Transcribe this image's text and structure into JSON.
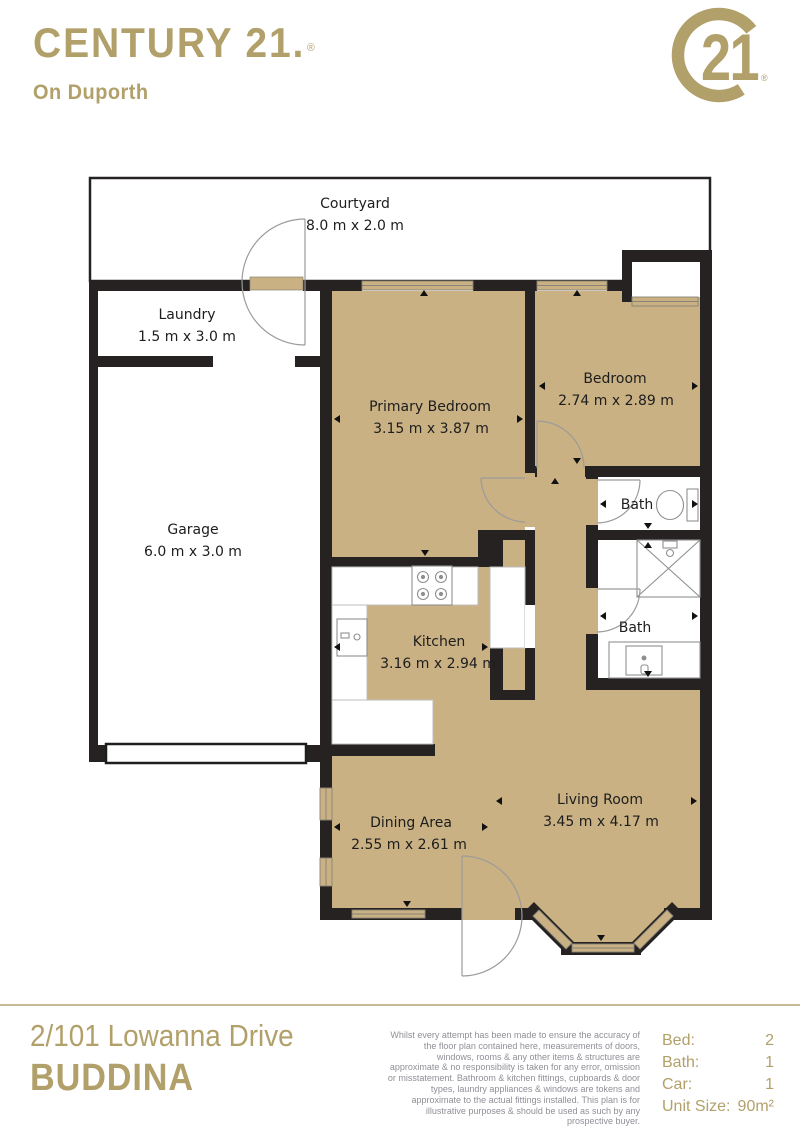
{
  "brand": {
    "wordmark": "CENTURY 21.",
    "registered_mark": "®",
    "office": "On Duporth",
    "seal_number": "21",
    "seal_registered_mark": "®"
  },
  "plan": {
    "rooms": {
      "courtyard": {
        "name": "Courtyard",
        "dims": "8.0 m x 2.0 m"
      },
      "laundry": {
        "name": "Laundry",
        "dims": "1.5 m x 3.0 m"
      },
      "garage": {
        "name": "Garage",
        "dims": "6.0 m x 3.0 m"
      },
      "primary_bedroom": {
        "name": "Primary Bedroom",
        "dims": "3.15 m x 3.87 m"
      },
      "bedroom": {
        "name": "Bedroom",
        "dims": "2.74 m x 2.89 m"
      },
      "bath_upper": {
        "name": "Bath"
      },
      "bath_lower": {
        "name": "Bath"
      },
      "kitchen": {
        "name": "Kitchen",
        "dims": "3.16 m x 2.94 m"
      },
      "dining": {
        "name": "Dining Area",
        "dims": "2.55 m x 2.61 m"
      },
      "living": {
        "name": "Living Room",
        "dims": "3.45 m x 4.17 m"
      }
    }
  },
  "footer": {
    "address_line1": "2/101 Lowanna Drive",
    "address_line2": "BUDDINA",
    "disclaimer": "Whilst every attempt has been made to ensure the accuracy of the floor plan contained here, measurements of doors, windows, rooms & any other items & structures are approximate & no responsibility is taken for any error, omission or misstatement. Bathroom & kitchen fittings, cupboards & door types, laundry appliances & windows are tokens and approximate to the actual fittings installed. This plan is for illustrative purposes & should be used as such by any prospective buyer.",
    "details": [
      {
        "label": "Bed:",
        "value": "2"
      },
      {
        "label": "Bath:",
        "value": "1"
      },
      {
        "label": "Car:",
        "value": "1"
      },
      {
        "label": "Unit Size:",
        "value": "90m²"
      }
    ]
  },
  "colors": {
    "brand_gold": "#B2A06A",
    "floor_tan": "#C9B183",
    "wall_black": "#262222",
    "label_text": "#1D1D1D",
    "disclaimer_gray": "#8F8F97",
    "divider_gold": "#C8BA94"
  }
}
